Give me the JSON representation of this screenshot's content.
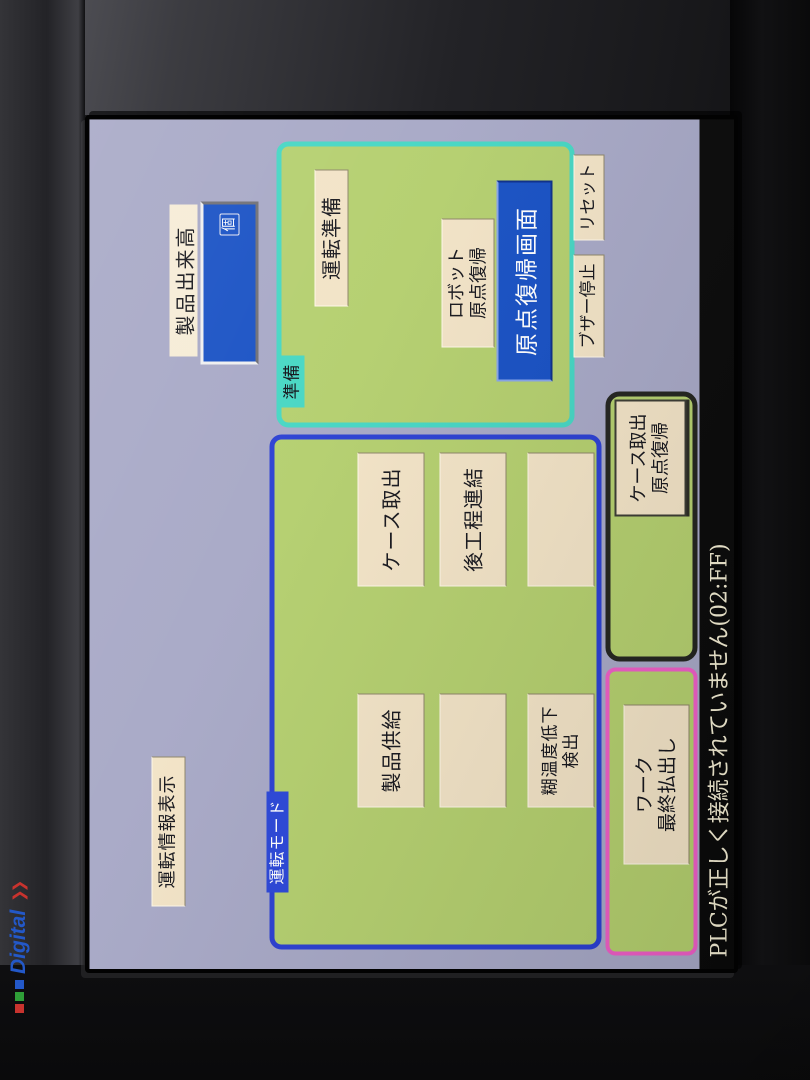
{
  "colors": {
    "screen_bg": "#a7a8c6",
    "section_bg": "#b4cf6e",
    "cyan": "#45d6c3",
    "blue_border": "#2a3fd2",
    "pink": "#ee5ec6",
    "dark_border": "#23241f",
    "beige": "#f2e3c6",
    "blue_fill": "#1750c4",
    "label_blue": "#2a46d8",
    "status_bg": "#0a0a0a",
    "status_text": "#f2ecd2",
    "logo_blue": "#2358c8",
    "logo_red": "#c8332e",
    "logo_green": "#2f9e38"
  },
  "bezel": {
    "brand": "Digital"
  },
  "status_bar": {
    "message": "PLCが正しく接続されていません(02:FF)"
  },
  "screen": {
    "info_display_button": "運転情報表示",
    "production_counter": {
      "label": "製品出来高",
      "unit": "個"
    },
    "prepare": {
      "title": "準備",
      "run_prepare_button": "運転準備",
      "robot_home_button": {
        "line1": "ロボット",
        "line2": "原点復帰"
      },
      "home_screen_button": "原点復帰画面"
    },
    "buzzer_stop_button": "ブザー停止",
    "reset_button": "リセット",
    "run_mode": {
      "title": "運転モード",
      "product_supply_button": "製品供給",
      "glue_temp_button": {
        "line1": "糊温度低下",
        "line2": "検出"
      },
      "case_takeout_button": "ケース取出",
      "post_process_button": "後工程連結"
    },
    "case_home_button": {
      "line1": "ケース取出",
      "line2": "原点復帰"
    },
    "work_discharge_button": {
      "line1": "ワーク",
      "line2": "最終払出し"
    }
  }
}
